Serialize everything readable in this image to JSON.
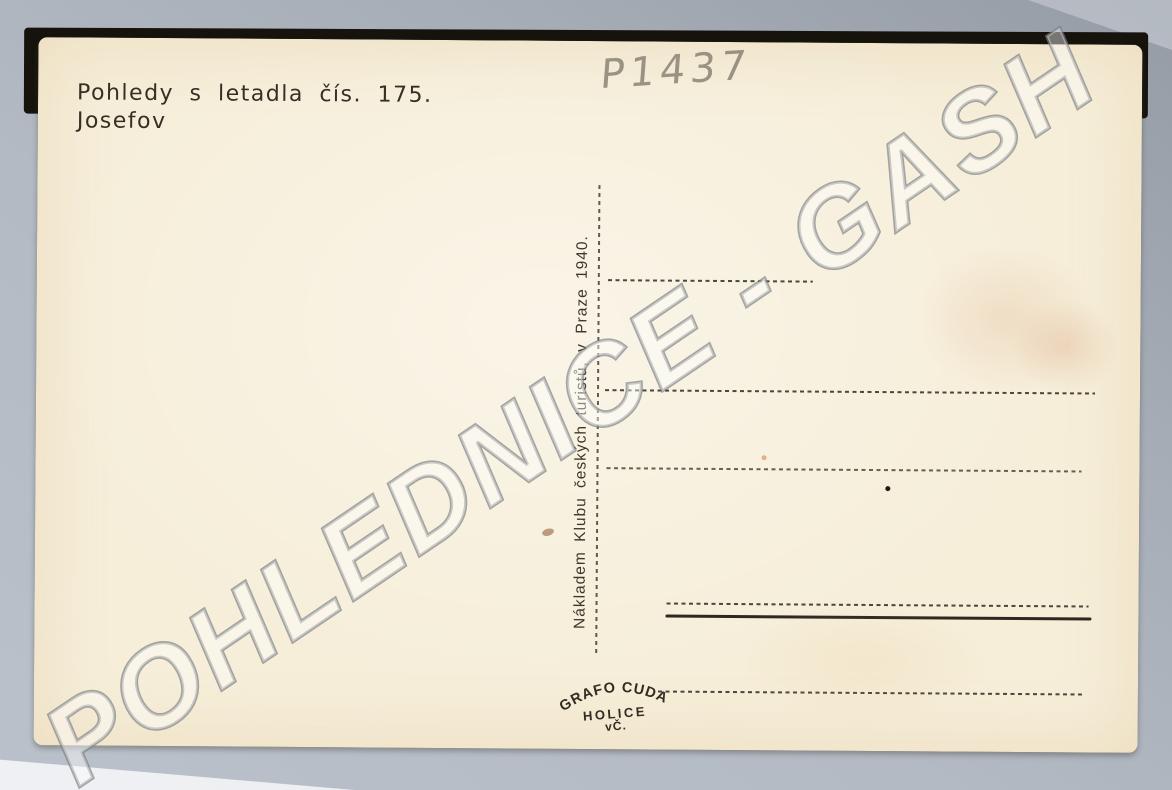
{
  "watermark": {
    "text": "POHLEDNICE - GASH"
  },
  "postcard": {
    "series_title": "Pohledy s letadla čís. 175.",
    "place_name": "Josefov",
    "handwritten_number": "P1437",
    "publisher_imprint": "Nákladem Klubu českých turistů, v Praze 1940.",
    "printer_stamp": {
      "arc_text": "GRAFO CUDA",
      "town": "HOLICE",
      "region": "vČ."
    }
  },
  "colors": {
    "card_paper": "#f6eed9",
    "photo_background": "#b3bac4",
    "black_backing": "#16130d",
    "printed_ink": "#362f25",
    "pencil": "#8b8376",
    "stain": "#cc8054"
  }
}
